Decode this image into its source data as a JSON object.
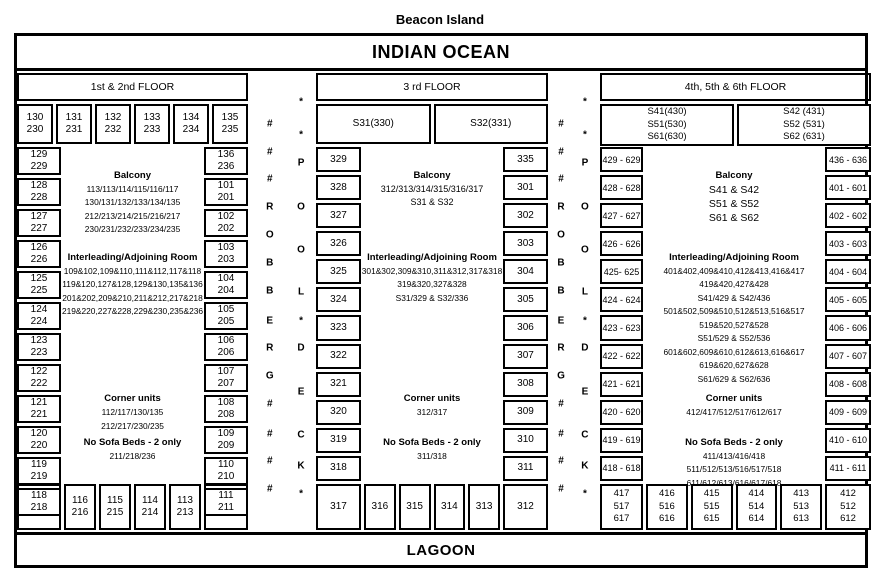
{
  "title": "Beacon Island",
  "ocean_label": "INDIAN OCEAN",
  "lagoon_label": "LAGOON",
  "strips": {
    "left_letters": [
      "#",
      "#",
      "#",
      "R",
      "O",
      "B",
      "B",
      "E",
      "R",
      "G",
      "#",
      "#",
      "#",
      "#"
    ],
    "right_letters": [
      "*",
      "*",
      "P",
      "O",
      "O",
      "L",
      "*",
      "D",
      "E",
      "C",
      "K",
      "*"
    ]
  },
  "sections": {
    "floor12": {
      "header": "1st & 2nd FLOOR",
      "top_cells": [
        "130\n230",
        "131\n231",
        "132\n232",
        "133\n233",
        "134\n234",
        "135\n235"
      ],
      "left_col": [
        "129\n229",
        "128\n228",
        "127\n227",
        "126\n226",
        "125\n225",
        "124\n224",
        "123\n223",
        "122\n222",
        "121\n221",
        "120\n220",
        "119\n219",
        "118\n218"
      ],
      "right_col": [
        "136\n236",
        "101\n201",
        "102\n202",
        "103\n203",
        "104\n204",
        "105\n205",
        "106\n206",
        "107\n207",
        "108\n208",
        "109\n209",
        "110\n210",
        "111\n211"
      ],
      "bottom_cells": [
        "117\n217",
        "116\n216",
        "115\n215",
        "114\n214",
        "113\n213",
        "112\n212"
      ],
      "notes": {
        "balcony": {
          "heading": "Balcony",
          "lines": [
            "113/113/114/115/116/117",
            "130/131/132/133/134/135",
            "212/213/214/215/216/217",
            "230/231/232/233/234/235"
          ]
        },
        "interleading": {
          "heading": "Interleading/Adjoining Room",
          "lines": [
            "109&102,109&110,111&112,117&118",
            "119&120,127&128,129&130,135&136",
            "201&202,209&210,211&212,217&218",
            "219&220,227&228,229&230,235&236"
          ]
        },
        "corner": {
          "heading": "Corner units",
          "lines": [
            "112/117/130/135",
            "212/217/230/235"
          ]
        },
        "no_sofa": {
          "heading": "No Sofa Beds - 2 only",
          "lines": [
            "211/218/236"
          ]
        }
      }
    },
    "floor3": {
      "header": "3 rd FLOOR",
      "top_cells": [
        "S31(330)",
        "S32(331)"
      ],
      "left_col": [
        "329",
        "328",
        "327",
        "326",
        "325",
        "324",
        "323",
        "322",
        "321",
        "320",
        "319",
        "318"
      ],
      "right_col": [
        "335",
        "301",
        "302",
        "303",
        "304",
        "305",
        "306",
        "307",
        "308",
        "309",
        "310",
        "311"
      ],
      "bottom_cells": [
        "317",
        "316",
        "315",
        "314",
        "313",
        "312"
      ],
      "notes": {
        "balcony": {
          "heading": "Balcony",
          "lines": [
            "312/313/314/315/316/317",
            "S31 & S32"
          ]
        },
        "interleading": {
          "heading": "Interleading/Adjoining Room",
          "lines": [
            "301&302,309&310,311&312,317&318",
            "319&320,327&328",
            "S31/329 & S32/336"
          ]
        },
        "corner": {
          "heading": "Corner units",
          "lines": [
            "312/317"
          ]
        },
        "no_sofa": {
          "heading": "No Sofa Beds - 2 only",
          "lines": [
            "311/318"
          ]
        }
      }
    },
    "floor456": {
      "header": "4th, 5th & 6th FLOOR",
      "top_cells": [
        "S41(430)\nS51(530)\nS61(630)",
        "S42 (431)\nS52 (531)\nS62 (631)"
      ],
      "left_col": [
        "429 - 629",
        "428 - 628",
        "427 - 627",
        "426 - 626",
        "425- 625",
        "424 - 624",
        "423 - 623",
        "422 - 622",
        "421 - 621",
        "420 - 620",
        "419 - 619",
        "418 - 618"
      ],
      "right_col": [
        "436 - 636",
        "401 - 601",
        "402 - 602",
        "403 - 603",
        "404 - 604",
        "405 - 605",
        "406 - 606",
        "407 - 607",
        "408 - 608",
        "409 - 609",
        "410 - 610",
        "411 - 611"
      ],
      "bottom_cells": [
        "417\n517\n617",
        "416\n516\n616",
        "415\n515\n615",
        "414\n514\n614",
        "413\n513\n613",
        "412\n512\n612"
      ],
      "notes": {
        "balcony": {
          "heading": "Balcony",
          "lines": [
            "S41 & S42",
            "S51 & S52",
            "S61 & S62"
          ]
        },
        "interleading": {
          "heading": "Interleading/Adjoining Room",
          "lines": [
            "401&402,409&410,412&413,416&417",
            "419&420,427&428",
            "S41/429 & S42/436",
            "501&502,509&510,512&513,516&517",
            "519&520,527&528",
            "S51/529 & S52/536",
            "601&602,609&610,612&613,616&617",
            "619&620,627&628",
            "S61/629 & S62/636"
          ]
        },
        "corner": {
          "heading": "Corner units",
          "lines": [
            "412/417/512/517/612/617"
          ]
        },
        "no_sofa": {
          "heading": "No Sofa Beds - 2 only",
          "lines": [
            "411/413/416/418",
            "511/512/513/516/517/518",
            "611/612/613/616/617/618"
          ]
        }
      }
    }
  }
}
